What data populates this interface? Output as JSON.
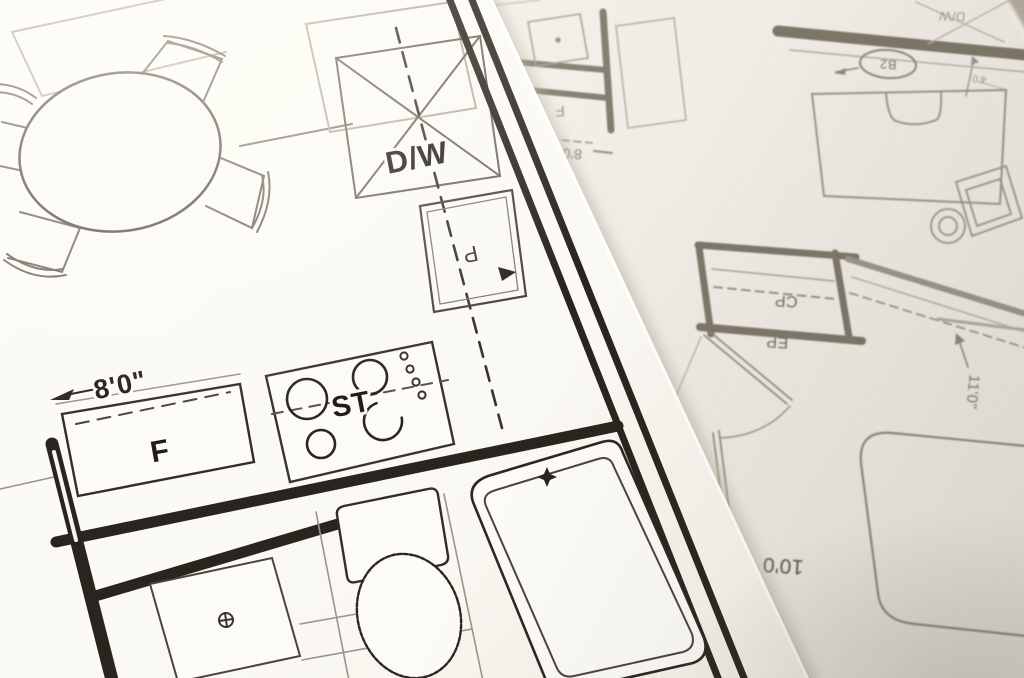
{
  "sheets": {
    "top": {
      "labels": {
        "dishwasher": "D/W",
        "stove": "ST",
        "refrigerator": "F",
        "cabinet": "P",
        "kitchen_width": "8'0\""
      }
    },
    "under": {
      "labels": {
        "refrigerator": "F",
        "fridge_width": "8'0",
        "closet": "CP",
        "closet2": "EP",
        "bedroom_depth": "11'0\"",
        "bedroom_width": "10'0",
        "room_tag": "B2",
        "dishwasher": "D/W",
        "small_dim": "4'0"
      }
    }
  },
  "colors": {
    "ink": "#29241d",
    "medium_ink": "#4a443c",
    "faded_ink": "#8d8779",
    "paper_top": "#fbfaf6",
    "paper_under": "#f1eee7",
    "edge_shadow": "#b3ab9c",
    "background_corner": "#b2ab9e"
  }
}
